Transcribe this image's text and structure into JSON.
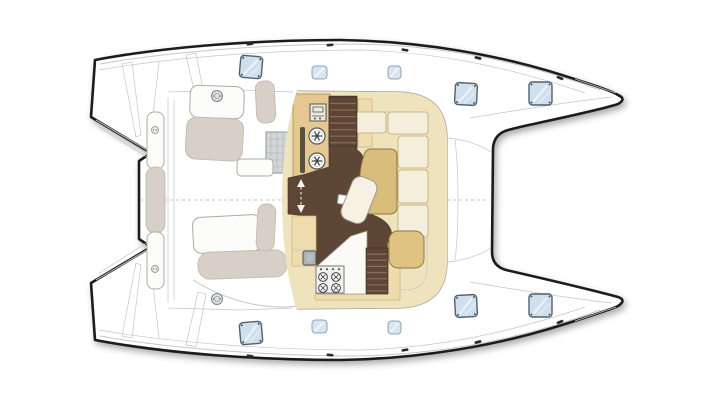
{
  "document": {
    "kind": "catamaran deck plan",
    "view": "top-down",
    "bows_facing": "right"
  },
  "palette": {
    "outline": "#1d1d1b",
    "thin": "#c3c7c6",
    "mid": "#9aa0a0",
    "floor": "#5d4636",
    "stair": "#8a6f54",
    "counter": "#e5c791",
    "counterBorder": "#a8905a",
    "band": "#efe3bd",
    "bandLine": "#c9b578",
    "cushion": "#f4eedd",
    "cushionBorder": "#c0aa6c",
    "tableK": "#d9bd7c",
    "tableBorder": "#8a7444",
    "bench": "#e0c383",
    "paleTan": "#eedcae",
    "greige": "#d8cfc7",
    "greigeBorder": "#c6beb6",
    "whiteF": "#fcfcfa",
    "whiteFBorder": "#ababa4",
    "hatch": "#cfdfed",
    "hatchBorder": "#53616e",
    "hatchSmall": "#d8e4ef",
    "hatchSmallBorder": "#93a5b3",
    "metal": "#b9bec3",
    "dark": "#3d3d3d"
  },
  "deck": {
    "hatches": [
      {
        "x": 240,
        "y": 56,
        "w": 22,
        "h": 22,
        "rot": 5,
        "style": "large"
      },
      {
        "x": 312,
        "y": 66,
        "w": 15,
        "h": 13,
        "rot": 0,
        "style": "small"
      },
      {
        "x": 388,
        "y": 66,
        "w": 13,
        "h": 13,
        "rot": 0,
        "style": "small"
      },
      {
        "x": 455,
        "y": 83,
        "w": 22,
        "h": 22,
        "rot": 3,
        "style": "large"
      },
      {
        "x": 529,
        "y": 82,
        "w": 23,
        "h": 23,
        "rot": 0,
        "style": "large"
      },
      {
        "x": 240,
        "y": 322,
        "w": 22,
        "h": 22,
        "rot": -5,
        "style": "large"
      },
      {
        "x": 312,
        "y": 320,
        "w": 15,
        "h": 13,
        "rot": 0,
        "style": "small"
      },
      {
        "x": 388,
        "y": 321,
        "w": 13,
        "h": 13,
        "rot": 0,
        "style": "small"
      },
      {
        "x": 455,
        "y": 295,
        "w": 22,
        "h": 22,
        "rot": -3,
        "style": "large"
      },
      {
        "x": 529,
        "y": 294,
        "w": 23,
        "h": 23,
        "rot": 0,
        "style": "large"
      }
    ],
    "cleats": [
      {
        "x": 250,
        "y": 44,
        "rot": -8
      },
      {
        "x": 330,
        "y": 45,
        "rot": -4
      },
      {
        "x": 405,
        "y": 50,
        "rot": 10
      },
      {
        "x": 478,
        "y": 58,
        "rot": 14
      },
      {
        "x": 560,
        "y": 78,
        "rot": 22
      },
      {
        "x": 250,
        "y": 356,
        "rot": 8
      },
      {
        "x": 330,
        "y": 355,
        "rot": 4
      },
      {
        "x": 405,
        "y": 350,
        "rot": -10
      },
      {
        "x": 478,
        "y": 342,
        "rot": -14
      },
      {
        "x": 560,
        "y": 322,
        "rot": -22
      }
    ],
    "winches": [
      {
        "x": 217,
        "y": 96
      },
      {
        "x": 217,
        "y": 299
      }
    ],
    "platform_fittings": [
      {
        "x": 155,
        "y": 130
      },
      {
        "x": 155,
        "y": 269
      }
    ]
  },
  "saloon": {
    "stairs": [
      {
        "x": 329,
        "y": 97,
        "w": 28,
        "h": 49,
        "steps": 7
      },
      {
        "x": 366,
        "y": 248,
        "w": 22,
        "h": 46,
        "steps": 7
      }
    ],
    "galley": {
      "fridge_symbols": [
        {
          "x": 317,
          "y": 136
        },
        {
          "x": 317,
          "y": 161
        }
      ],
      "stove": {
        "x": 316,
        "y": 266,
        "w": 28,
        "h": 27,
        "burners": [
          [
            323,
            277
          ],
          [
            336,
            277
          ],
          [
            323,
            288
          ],
          [
            336,
            288
          ]
        ],
        "knobs": [
          321,
          327,
          333,
          339
        ]
      },
      "sink": {
        "x": 303,
        "y": 251,
        "w": 13,
        "h": 14
      },
      "oven": {
        "x": 310,
        "y": 104,
        "w": 16,
        "h": 17
      }
    }
  }
}
